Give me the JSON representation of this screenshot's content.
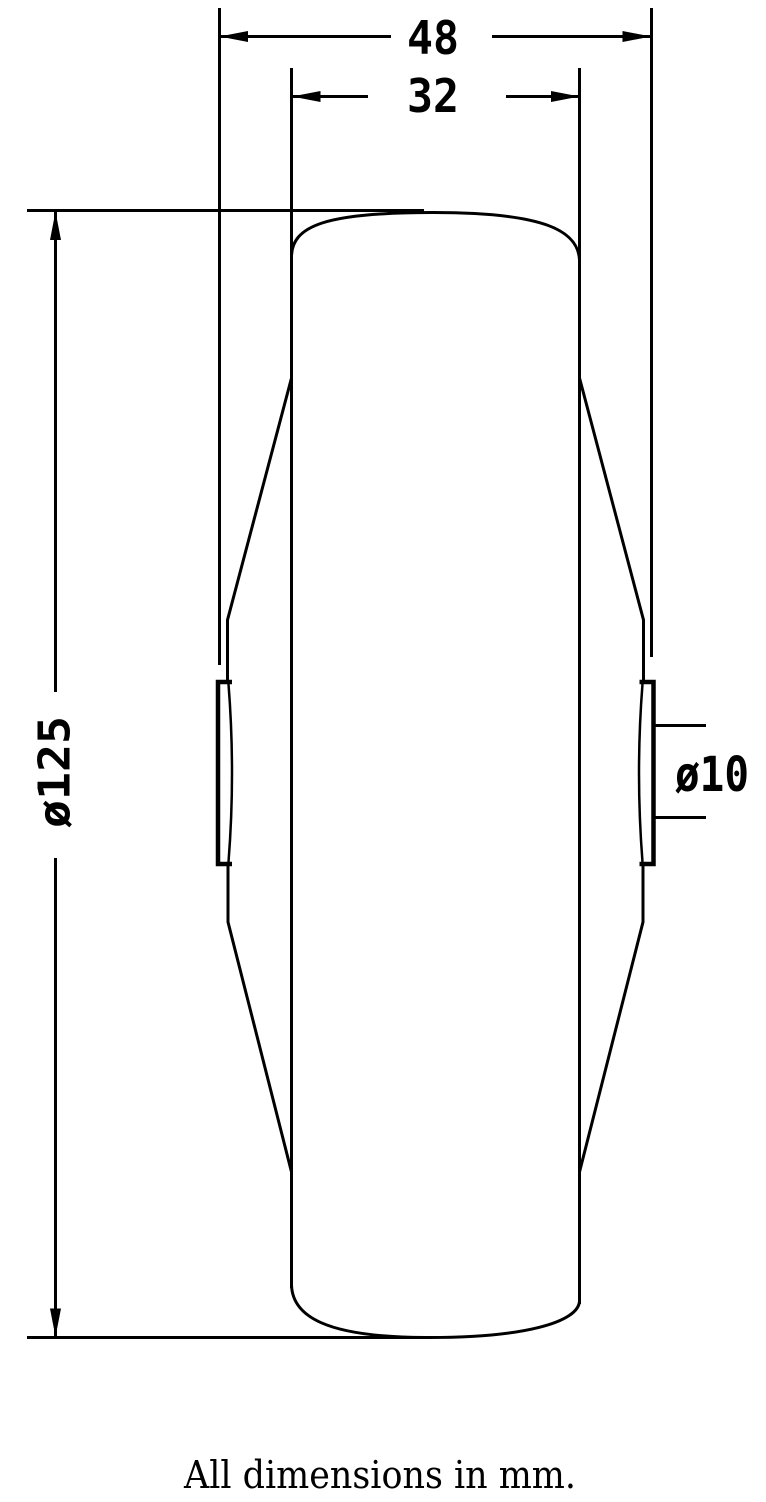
{
  "drawing": {
    "dimensions": {
      "overall_width": {
        "label": "48"
      },
      "tread_width": {
        "label": "32"
      },
      "wheel_diameter": {
        "label": "ø125"
      },
      "bore_diameter": {
        "label": "ø10"
      }
    },
    "caption": "All dimensions in mm.",
    "colors": {
      "line": "#000000",
      "background": "#ffffff"
    }
  }
}
